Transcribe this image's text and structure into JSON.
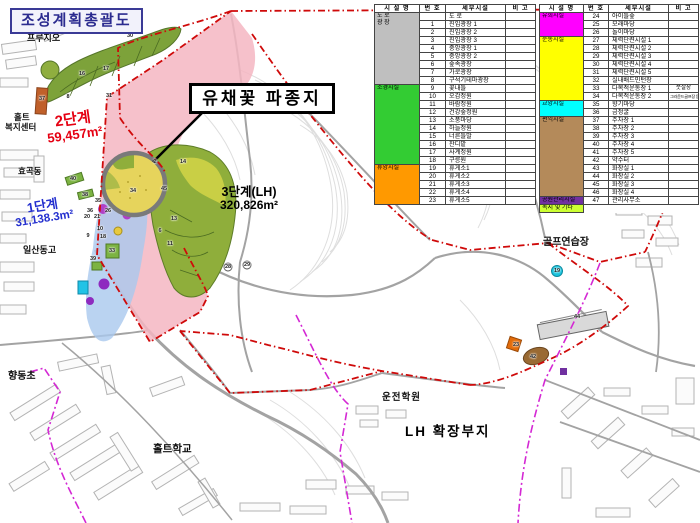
{
  "title": "조성계획총괄도",
  "callout": {
    "label": "유채꽃 파종지"
  },
  "phases": {
    "phase1": {
      "name": "1단계",
      "area": "31,138.3m²",
      "color": "#2430cf"
    },
    "phase2": {
      "name": "2단계",
      "area": "59,457m²",
      "color": "#e50012"
    },
    "phase3": {
      "name": "3단계(LH)",
      "area": "320,826m²",
      "color": "#000000"
    },
    "lh_expansion": {
      "name": "LH 확장부지"
    }
  },
  "map_labels": {
    "prugio": "프루지오",
    "holt_line1": "홀트",
    "holt_line2": "복지센터",
    "hyogok": "효곡동",
    "ilsan_high": "일산동고",
    "elementary": "향동초",
    "holt_school": "홀트학교",
    "driving_school": "운전학원",
    "golf_range": "골프연습장"
  },
  "legend": {
    "headers": [
      "시 설 명",
      "번 호",
      "세부시설",
      "비 고"
    ],
    "left_groups": [
      {
        "name": "도 로\n광 장",
        "color": "#BFBFBF",
        "rows": [
          [
            "",
            "도 로",
            ""
          ],
          [
            "1",
            "진입광장 1",
            ""
          ],
          [
            "2",
            "진입광장 2",
            ""
          ],
          [
            "3",
            "진입광장 3",
            ""
          ],
          [
            "4",
            "중앙광장 1",
            ""
          ],
          [
            "5",
            "중앙광장 2",
            ""
          ],
          [
            "6",
            "숲속광장",
            ""
          ],
          [
            "7",
            "가로광장",
            ""
          ],
          [
            "8",
            "구석기테마광장",
            ""
          ]
        ]
      },
      {
        "name": "조경시설",
        "color": "#33CC33",
        "rows": [
          [
            "9",
            "꽃내들",
            ""
          ],
          [
            "10",
            "오감정원",
            ""
          ],
          [
            "11",
            "바람정원",
            ""
          ],
          [
            "12",
            "건강숲정원",
            ""
          ],
          [
            "13",
            "소풍마당",
            ""
          ],
          [
            "14",
            "하늘정원",
            ""
          ],
          [
            "15",
            "너른들말",
            ""
          ],
          [
            "16",
            "잔디밭",
            ""
          ],
          [
            "17",
            "사계정원",
            ""
          ],
          [
            "18",
            "구릉원",
            ""
          ]
        ]
      },
      {
        "name": "휴양시설",
        "color": "#FF9900",
        "rows": [
          [
            "19",
            "휴게소1",
            ""
          ],
          [
            "20",
            "휴게소2",
            ""
          ],
          [
            "21",
            "휴게소3",
            ""
          ],
          [
            "22",
            "휴게소4",
            ""
          ],
          [
            "23",
            "휴게소5",
            ""
          ]
        ]
      }
    ],
    "right_groups": [
      {
        "name": "유희시설",
        "color": "#FF00FF",
        "rows": [
          [
            "24",
            "아이들숲",
            ""
          ],
          [
            "25",
            "모래마당",
            ""
          ],
          [
            "26",
            "놀이마당",
            ""
          ]
        ]
      },
      {
        "name": "운동시설",
        "color": "#FFFF00",
        "rows": [
          [
            "27",
            "체력단련시설 1",
            ""
          ],
          [
            "28",
            "체력단련시설 2",
            ""
          ],
          [
            "29",
            "체력단련시설 3",
            ""
          ],
          [
            "30",
            "체력단련시설 4",
            ""
          ],
          [
            "31",
            "체력단련시설 5",
            ""
          ],
          [
            "32",
            "실내배드민턴장",
            ""
          ],
          [
            "33",
            "다목적운동장 1",
            "풋살장"
          ],
          [
            "34",
            "다목적운동장 2",
            "그라운드골프장 등"
          ]
        ]
      },
      {
        "name": "교양시설",
        "color": "#00FFFF",
        "rows": [
          [
            "35",
            "향기마당",
            ""
          ],
          [
            "36",
            "금정굴",
            ""
          ]
        ]
      },
      {
        "name": "편익시설",
        "color": "#B48A5A",
        "rows": [
          [
            "37",
            "주차장 1",
            ""
          ],
          [
            "38",
            "주차장 2",
            ""
          ],
          [
            "39",
            "주차장 3",
            ""
          ],
          [
            "40",
            "주차장 4",
            ""
          ],
          [
            "41",
            "주차장 5",
            ""
          ],
          [
            "42",
            "약수터",
            ""
          ],
          [
            "43",
            "화장실 1",
            ""
          ],
          [
            "44",
            "화장실 2",
            ""
          ],
          [
            "45",
            "화장실 3",
            ""
          ],
          [
            "46",
            "화장실 4",
            ""
          ]
        ]
      },
      {
        "name": "공원관리시설",
        "color": "#7030A0",
        "rows": [
          [
            "47",
            "관리사무소",
            ""
          ]
        ]
      },
      {
        "name": "녹지 및 기타",
        "color": "#CCFF33",
        "rows": []
      }
    ]
  },
  "markers": [
    {
      "n": "30",
      "x": 130,
      "y": 36
    },
    {
      "n": "16",
      "x": 82,
      "y": 74
    },
    {
      "n": "17",
      "x": 106,
      "y": 69
    },
    {
      "n": "31",
      "x": 109,
      "y": 96
    },
    {
      "n": "8",
      "x": 68,
      "y": 97
    },
    {
      "n": "37",
      "x": 42,
      "y": 99
    },
    {
      "n": "2",
      "x": 155,
      "y": 162
    },
    {
      "n": "14",
      "x": 183,
      "y": 162
    },
    {
      "n": "45",
      "x": 164,
      "y": 189
    },
    {
      "n": "34",
      "x": 133,
      "y": 191
    },
    {
      "n": "13",
      "x": 174,
      "y": 219
    },
    {
      "n": "11",
      "x": 170,
      "y": 244
    },
    {
      "n": "6",
      "x": 160,
      "y": 231
    },
    {
      "n": "40",
      "x": 73,
      "y": 179
    },
    {
      "n": "38",
      "x": 85,
      "y": 195
    },
    {
      "n": "35",
      "x": 98,
      "y": 201
    },
    {
      "n": "26",
      "x": 108,
      "y": 211
    },
    {
      "n": "36",
      "x": 90,
      "y": 211
    },
    {
      "n": "20",
      "x": 87,
      "y": 217
    },
    {
      "n": "21",
      "x": 97,
      "y": 217
    },
    {
      "n": "10",
      "x": 100,
      "y": 229
    },
    {
      "n": "18",
      "x": 103,
      "y": 237
    },
    {
      "n": "9",
      "x": 88,
      "y": 236
    },
    {
      "n": "39",
      "x": 93,
      "y": 259
    },
    {
      "n": "33",
      "x": 112,
      "y": 251
    },
    {
      "n": "28",
      "x": 228,
      "y": 267
    },
    {
      "n": "29",
      "x": 247,
      "y": 265
    },
    {
      "n": "19",
      "x": 557,
      "y": 271
    },
    {
      "n": "42",
      "x": 533,
      "y": 357
    },
    {
      "n": "23",
      "x": 516,
      "y": 345
    },
    {
      "n": "44",
      "x": 577,
      "y": 317
    }
  ]
}
